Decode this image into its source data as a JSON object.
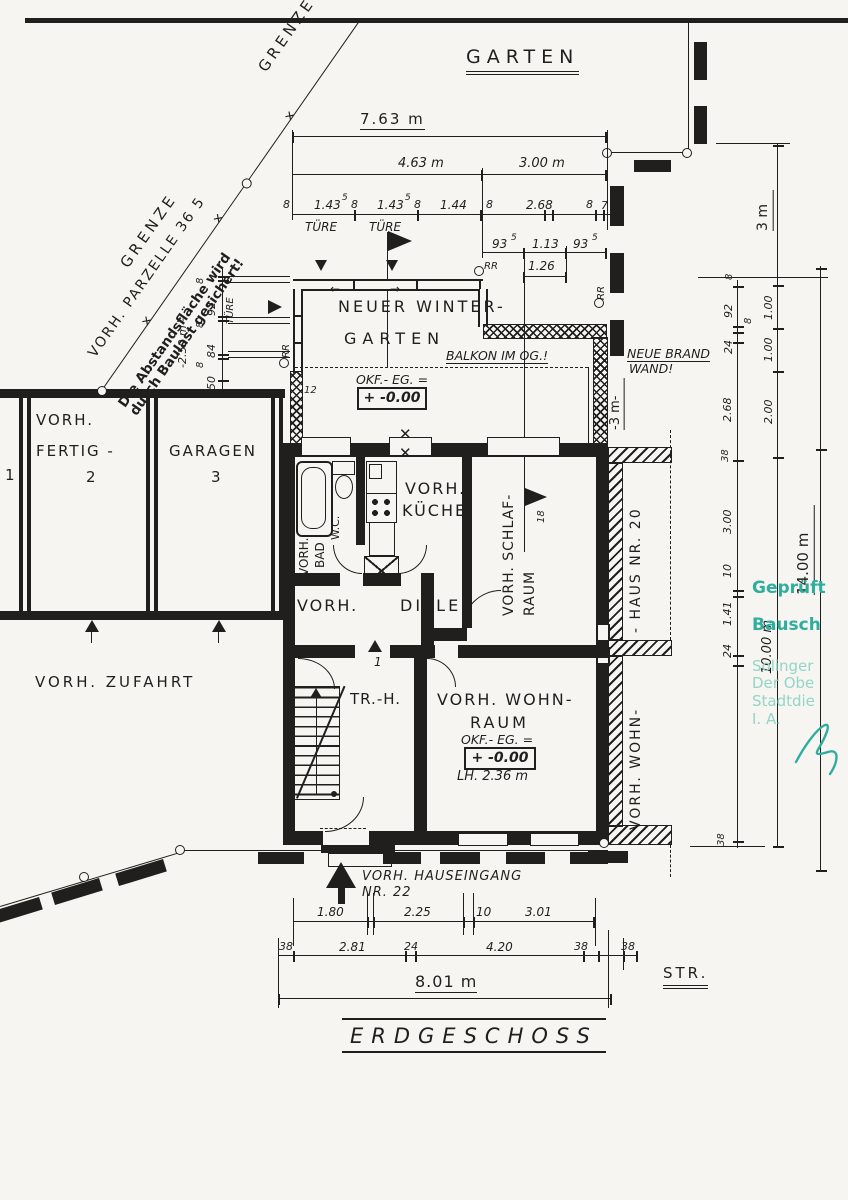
{
  "site": {
    "garten": "GARTEN",
    "grenze": "GRENZE",
    "parzelle": "VORH. PARZELLE 36 5",
    "note1": "Die Abstandsfläche wird",
    "note2": "durch Baulast gesichert!",
    "zufahrt": "VORH. ZUFAHRT",
    "strasse": "STR.",
    "title": "ERDGESCHOSS",
    "haus20": "- HAUS NR. 20",
    "wohn_right": "VORH. WOHN-",
    "brandwand1": "NEUE BRAND",
    "brandwand2": "WAND!",
    "balkon": "BALKON IM OG.!",
    "hauseingang1": "VORH. HAUSEINGANG",
    "hauseingang2": "NR. 22"
  },
  "rooms": {
    "wg1": "NEUER WINTER-",
    "wg2": "GARTEN",
    "kueche1": "VORH.",
    "kueche2": "KÜCHE",
    "bad1": "VORH.",
    "bad2": "BAD",
    "wc": "W.C.",
    "schlaf1": "VORH. SCHLAF-",
    "schlaf2": "RAUM",
    "diele1": "VORH.",
    "diele2": "DIELE",
    "trh": "TR.-H.",
    "wohn1": "VORH. WOHN-",
    "wohn2": "RAUM",
    "fertig1": "VORH.",
    "fertig2": "FERTIG -",
    "fertig_no": "2",
    "garagen": "GARAGEN",
    "garagen_no": "3",
    "garage1_no": "1"
  },
  "levels": {
    "okf": "OKF.- EG. =",
    "val": "+ -0.00",
    "lh": "LH. 2.36 m"
  },
  "dims": {
    "total_top": "7.63 m",
    "d463": "4.63 m",
    "d300": "3.00 m",
    "n8": "8",
    "n143": "1.43",
    "sup5": "5",
    "n144": "1.44",
    "n268": "2.68",
    "n7": "7",
    "ture": "TÜRE",
    "n93": "93",
    "n113": "1.13",
    "n126": "1.26",
    "n92": "92",
    "n84": "84",
    "n50": "50",
    "m250": "-2.50 m -",
    "n24": "24",
    "n38": "38",
    "n300": "3.00",
    "n10": "10",
    "n141": "1.41",
    "n100": "1.00",
    "n200": "2.00",
    "m3": "3 m",
    "m3r": "-3 m-",
    "m10": "10.00 m",
    "m14": "14.00 m",
    "n180": "1.80",
    "n225": "2.25",
    "n301": "3.01",
    "n281": "2.81",
    "n420": "4.20",
    "total_bottom": "8.01 m",
    "n12": "12",
    "n1": "1",
    "n18": "18",
    "rr": "RR",
    "x": "✕",
    "arrow_l": "←",
    "arrow_r": "→"
  },
  "stamp": {
    "l1": "Geprüft",
    "l2": "Bausch",
    "l3": "Solinger",
    "l4": "Der Obe",
    "l5": "Stadtdie",
    "l6": "I. A."
  }
}
